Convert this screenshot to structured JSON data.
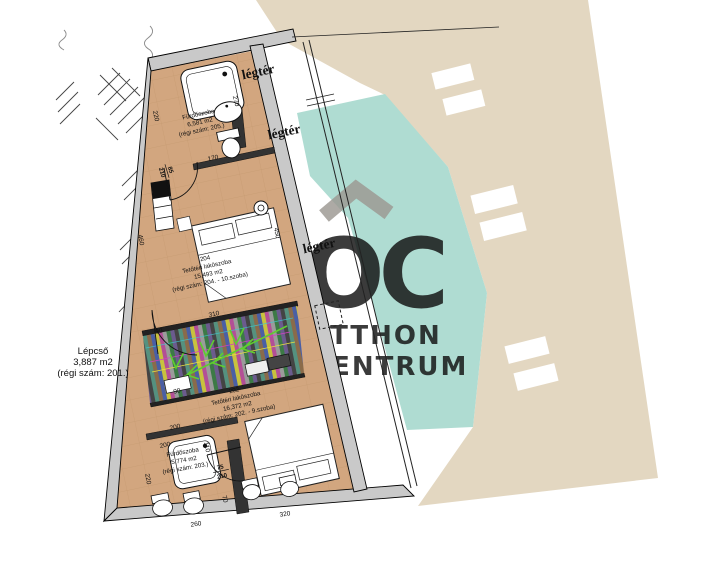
{
  "watermark": {
    "roof_icon": "roof-chevron",
    "logo": "OC",
    "line1": "OTTHON",
    "line2": "CENTRUM"
  },
  "colors": {
    "beige": "#e3d7c1",
    "teal": "#afdcd2",
    "wall_gray": "#c9c9c9",
    "floor_tan": "#d2a67f",
    "watermark_gray": "#9c9892",
    "stair_green": "#5fce2f"
  },
  "void_labels": {
    "legter": "légtér"
  },
  "rooms": {
    "bath_top": {
      "name": "Fürdőszoba",
      "area": "6,581 m2",
      "old_num": "(régi szám: 205.)"
    },
    "room_204": {
      "number": "204",
      "name": "Tetőtéri lakószoba",
      "area": "15,493 m2",
      "old_num": "(régi szám: 204. - 10.szoba)"
    },
    "room_202": {
      "number": "202",
      "name": "Tetőtéri lakószoba",
      "area": "16,372 m2",
      "old_num": "(régi szám: 202. - 9.szoba)"
    },
    "bath_bottom": {
      "name": "Fürdőszoba",
      "area": "5,774 m2",
      "old_num": "(régi szám: 203.)"
    },
    "staircase": {
      "name": "Lépcső",
      "area": "3,887 m2",
      "old_num": "(régi szám: 201.)"
    }
  },
  "dimensions": {
    "d220_top": "220",
    "d170": "170",
    "d460": "460",
    "d270": "270",
    "d450": "450",
    "d310": "310",
    "d90_a": "90",
    "d90_b": "90",
    "d200_a": "200",
    "d200_b": "200",
    "d110": "110",
    "d220_bottom": "220",
    "d70": "70",
    "d260": "260",
    "d320": "320",
    "door_top_w": "85",
    "door_top_h": "210",
    "door_bottom_w": "75",
    "door_bottom_h": "210"
  }
}
